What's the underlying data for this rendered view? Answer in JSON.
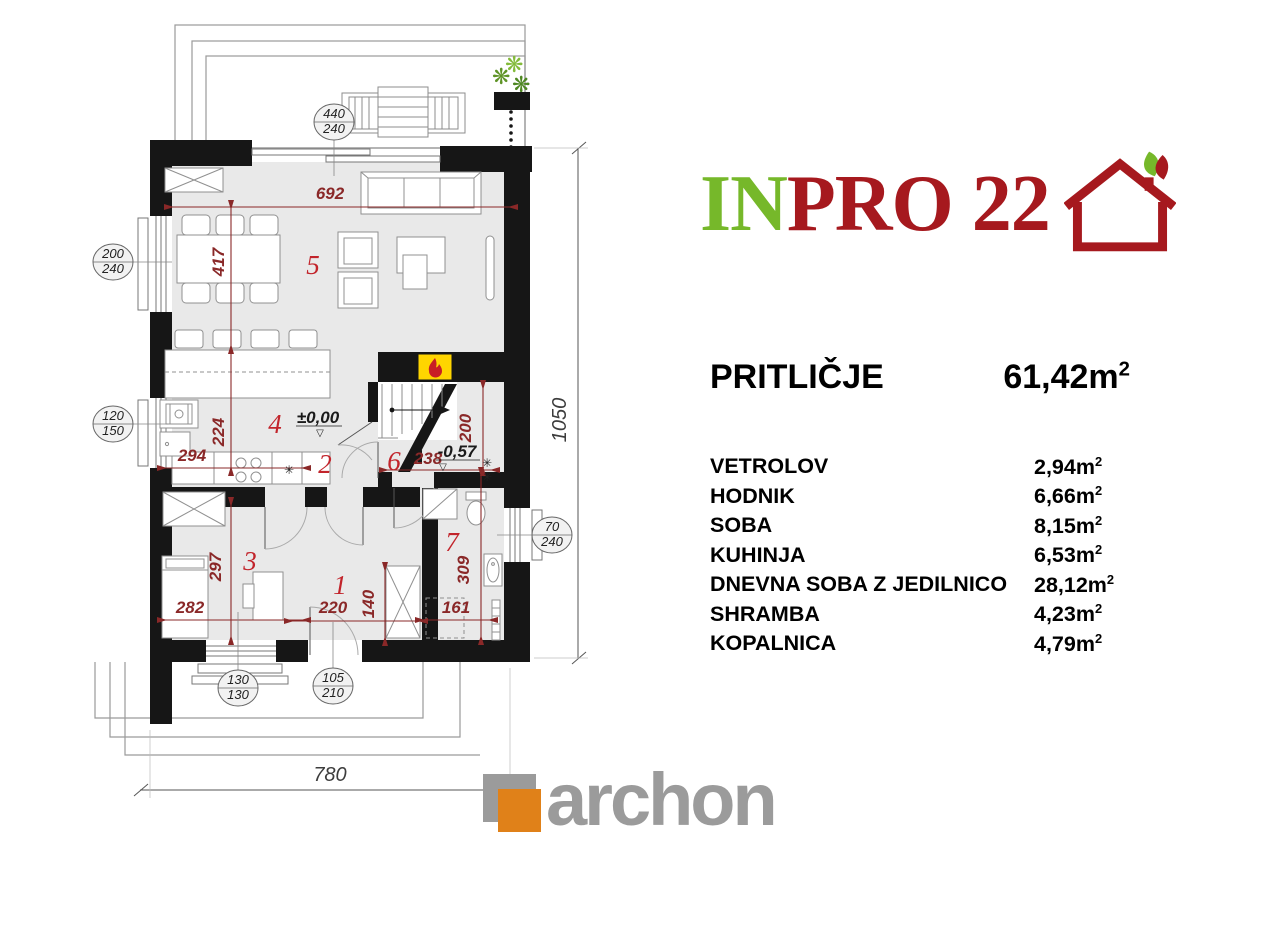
{
  "header_logo": {
    "text_green": "IN",
    "text_red": "PRO 22",
    "green": "#76b82a",
    "red": "#a6191e"
  },
  "title": {
    "name": "PRITLIČJE",
    "area_value": "61,42m",
    "sup": "2"
  },
  "legend": {
    "sup": "2",
    "rows": [
      {
        "name": "VETROLOV",
        "area": "2,94m"
      },
      {
        "name": "HODNIK",
        "area": "6,66m"
      },
      {
        "name": "SOBA",
        "area": "8,15m"
      },
      {
        "name": "KUHINJA",
        "area": "6,53m"
      },
      {
        "name": "DNEVNA SOBA Z JEDILNICO",
        "area": "28,12m"
      },
      {
        "name": "SHRAMBA",
        "area": "4,23m"
      },
      {
        "name": "KOPALNICA",
        "area": "4,79m"
      }
    ]
  },
  "footer": {
    "brand": "archon",
    "orange": "#e08119",
    "gray": "#9b9b9b"
  },
  "plan": {
    "room_numbers": {
      "r1": "1",
      "r2": "2",
      "r3": "3",
      "r4": "4",
      "r5": "5",
      "r6": "6",
      "r7": "7"
    },
    "dimensions": {
      "d692": "692",
      "d417": "417",
      "d294": "294",
      "d224": "224",
      "d297": "297",
      "d282": "282",
      "d220": "220",
      "d140": "140",
      "d161": "161",
      "d309": "309",
      "d238": "238",
      "d200": "200",
      "overall_width": "780",
      "overall_height": "1050"
    },
    "levels": {
      "ground": "±0,00",
      "cellar": "-0,57",
      "marker": "▽"
    },
    "openings": {
      "o440": {
        "w": "440",
        "h": "240"
      },
      "o200": {
        "w": "200",
        "h": "240"
      },
      "o120": {
        "w": "120",
        "h": "150"
      },
      "o70": {
        "w": "70",
        "h": "240"
      },
      "o130": {
        "w": "130",
        "h": "130"
      },
      "o105": {
        "w": "105",
        "h": "210"
      }
    },
    "symbols": {
      "vent": "✳",
      "plant": "❋"
    }
  }
}
